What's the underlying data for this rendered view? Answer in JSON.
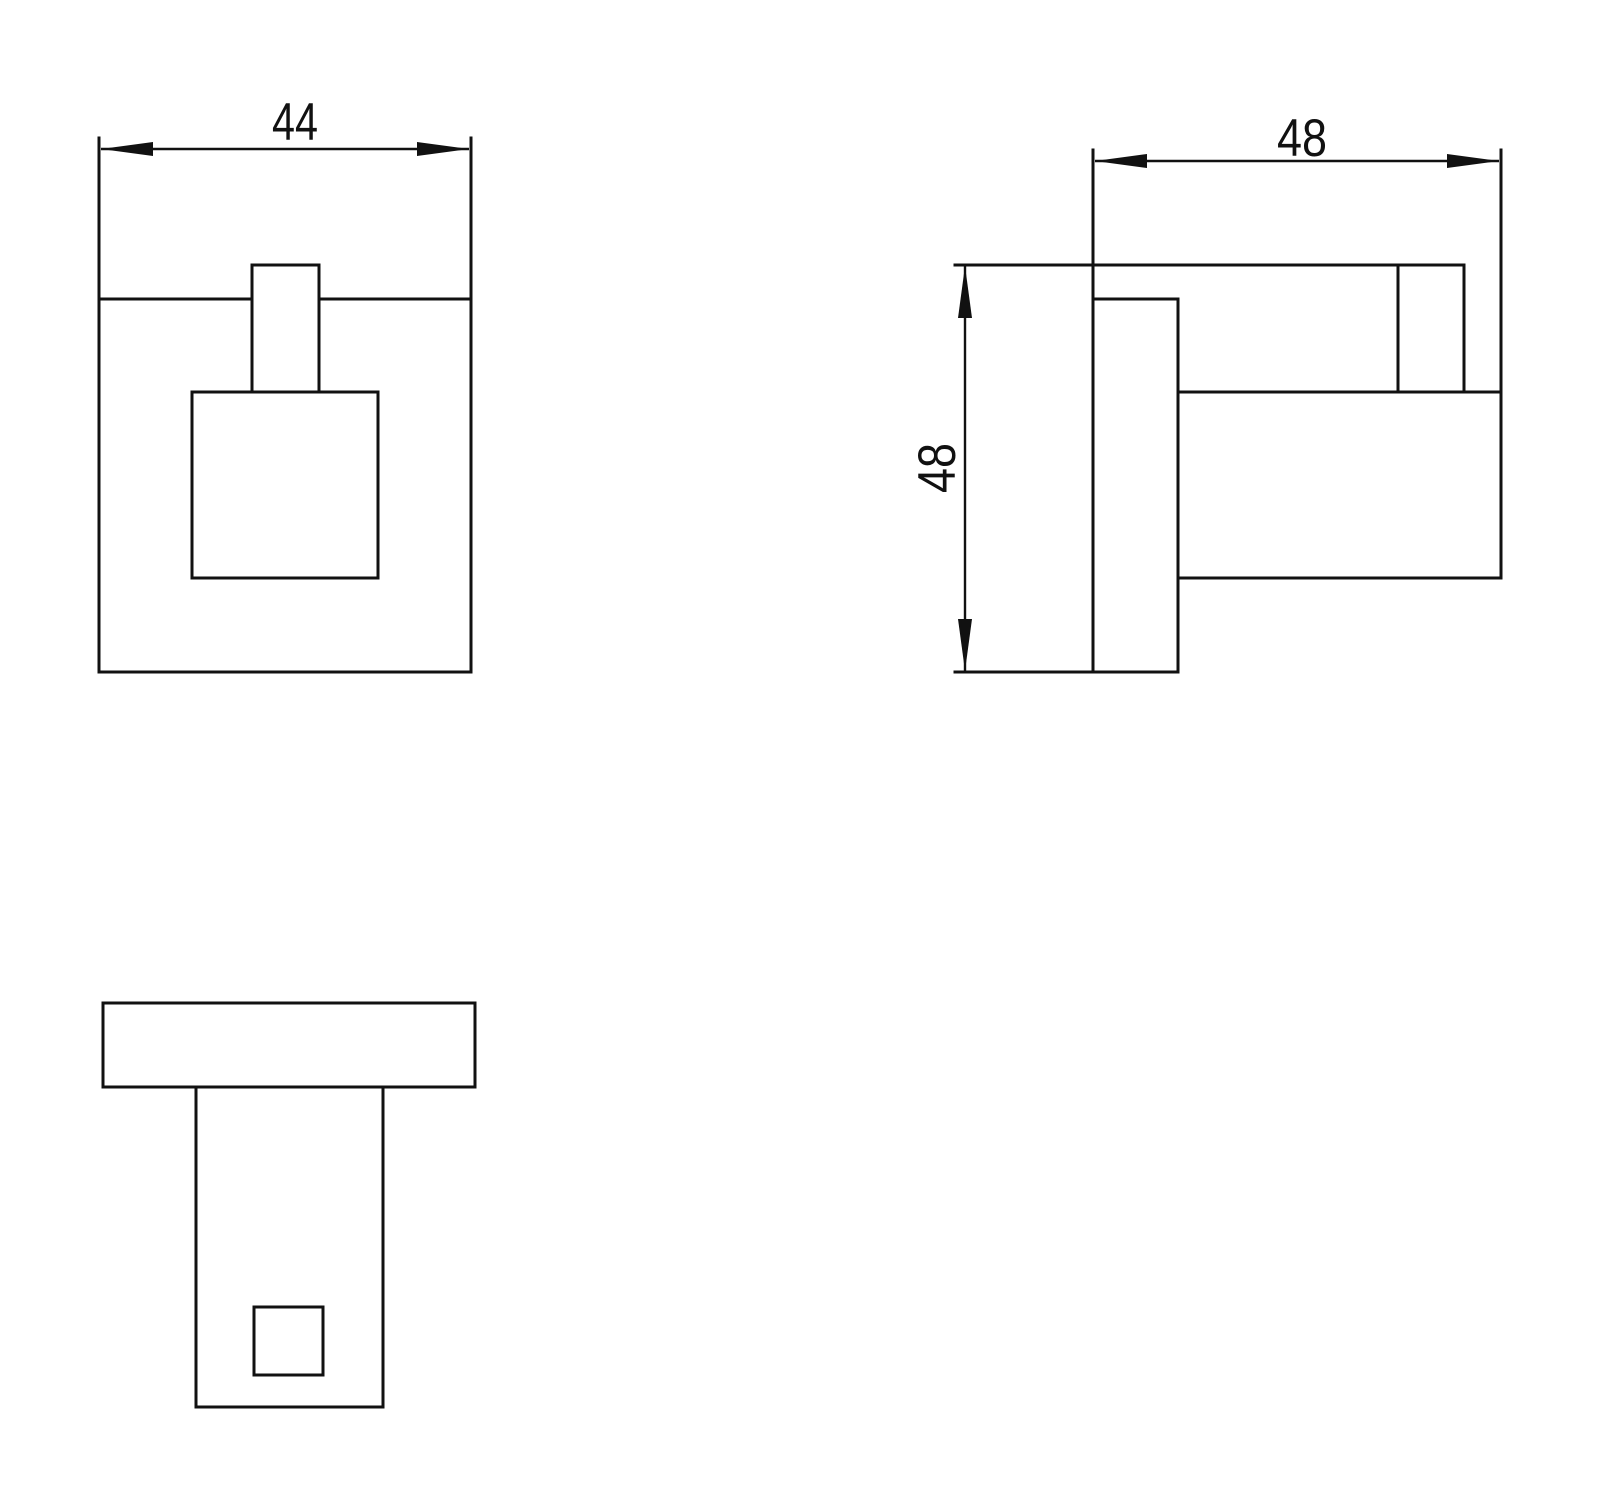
{
  "drawing": {
    "background": "#ffffff",
    "line_color": "#111111",
    "dimensions": {
      "front_width": "44",
      "side_depth": "48",
      "side_height": "48"
    }
  }
}
